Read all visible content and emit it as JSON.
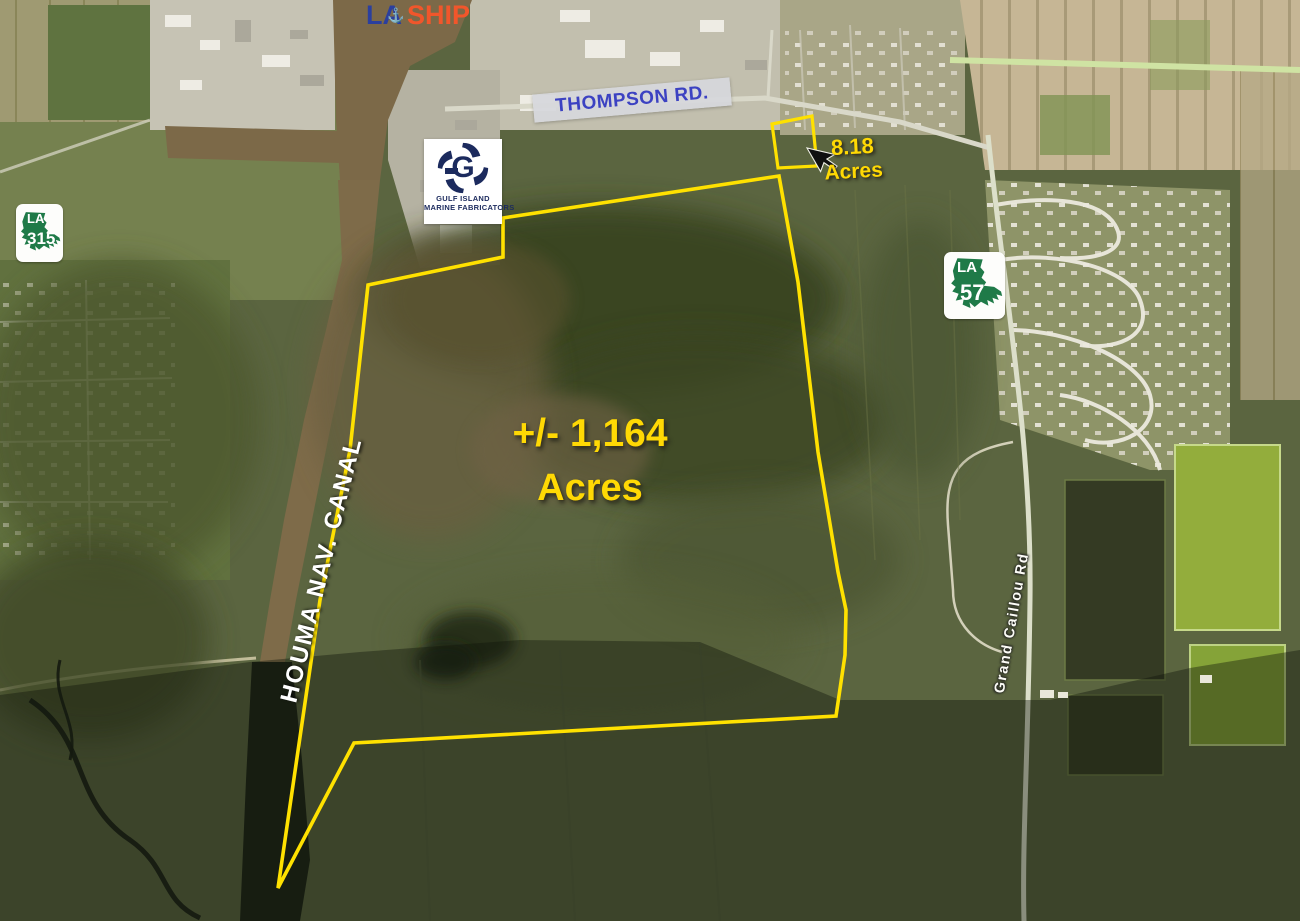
{
  "map": {
    "region_labels": {
      "thompson_rd": "THOMPSON RD.",
      "houma_nav_canal": "HOUMA NAV. CANAL",
      "grand_caillou_rd": "Grand Caillou Rd"
    },
    "acreage_main": {
      "line1": "+/- 1,164",
      "line2": "Acres"
    },
    "acreage_small": {
      "line1": "8.18",
      "line2": "Acres"
    },
    "laship_logo": {
      "la": "LA",
      "ship": "SHIP",
      "anchor_glyph": "⚓"
    },
    "gulf_island_logo": {
      "letter": "G",
      "line1": "GULF ISLAND",
      "line2": "MARINE FABRICATORS"
    },
    "shields": {
      "la315": {
        "state": "LA",
        "route": "315"
      },
      "la57": {
        "state": "LA",
        "route": "57"
      }
    },
    "colors": {
      "boundary_yellow": "#ffe100",
      "acreage_text_yellow": "#ffd904",
      "thompson_text_blue": "#3c42c2",
      "shield_green": "#1f7a48",
      "laship_blue": "#2b3f9e",
      "laship_orange": "#f1562b",
      "gulf_navy": "#1c2b5e",
      "road_label_white": "#ffffff"
    }
  }
}
